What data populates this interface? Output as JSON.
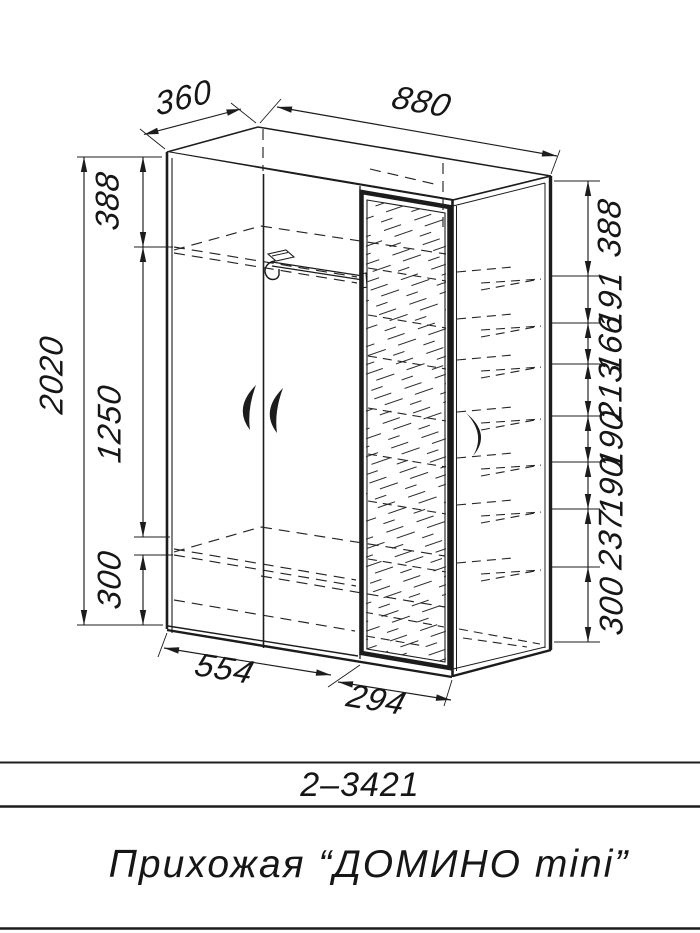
{
  "drawing": {
    "dim_depth": "360",
    "dim_width": "880",
    "dim_height_overall": "2020",
    "left_chain": [
      "388",
      "1250",
      "300"
    ],
    "right_chain": [
      "388",
      "191",
      "166",
      "213",
      "190",
      "190",
      "237",
      "300"
    ],
    "bottom_chain": [
      "554",
      "294"
    ]
  },
  "title_block": {
    "model_code": "2–3421",
    "product_name": "Прихожая “ДОМИНО mini”"
  },
  "colors": {
    "ink": "#1c1c1c",
    "background": "#ffffff"
  }
}
